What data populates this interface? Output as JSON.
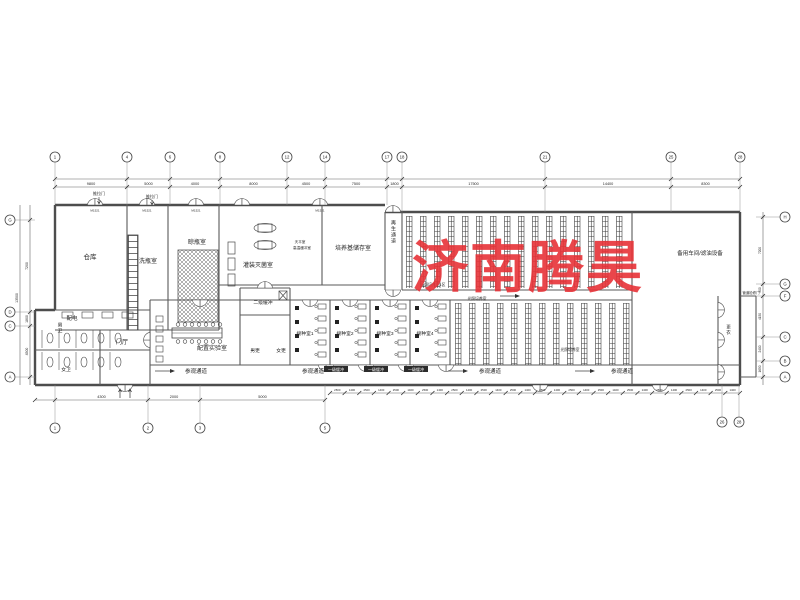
{
  "watermark": {
    "text": "济南腾昊",
    "color": "#e73338"
  },
  "grid": {
    "top": [
      "1",
      "4",
      "6",
      "8",
      "12",
      "14",
      "17",
      "18",
      "21",
      "25",
      "28"
    ],
    "bottom_left": [
      "1",
      "2",
      "3",
      "5"
    ],
    "bottom_right": [
      "26",
      "28"
    ],
    "left": [
      "G",
      "D",
      "C",
      "A"
    ],
    "right": [
      "H",
      "G",
      "F",
      "C",
      "B",
      "A"
    ]
  },
  "dims": {
    "top_row": [
      "9800",
      "5000",
      "4000",
      "8000",
      "4500",
      "7500",
      "1800",
      "17500",
      "14400",
      "8300"
    ],
    "bottom_left_row": [
      "4300",
      "2000",
      "5000"
    ],
    "bottom_ticks": [
      "2500",
      "1400"
    ],
    "left_col": [
      "7200",
      "1800",
      "4500"
    ],
    "left_total": "13500",
    "right_col": [
      "7200",
      "900",
      "4150",
      "2400",
      "1650"
    ]
  },
  "rooms": {
    "warehouse": "仓库",
    "bottle_wash": "洗瓶室",
    "bottle_dry": "晾瓶室",
    "filling": "灌装灭菌室",
    "medium_storage": "培养基储存室",
    "regen_corridor": "再生通道",
    "spare_workshop": "备用车间/滤油设备",
    "power": "配电",
    "toilet_m": "男卫",
    "toilet_f": "女卫",
    "hall": "门厅",
    "prep_lab": "配置实验室",
    "buffer2": "二级缓冲",
    "change_m": "男更",
    "change_f": "女更",
    "inoc1": "接种室1",
    "inoc2": "接种室2",
    "inoc3": "接种室3",
    "inoc4": "接种室4",
    "visitor": "参观通道",
    "light_culture": "光照培养室",
    "light_culture1": "光照培养室1区",
    "change": "更衣"
  },
  "annotations": {
    "sliding_door": "推拉门",
    "balance": "天平室",
    "hot_buffer": "高温缓冲室",
    "pipe_door": "管道检修门",
    "buffer1": "一级缓冲",
    "door_code": "M1521"
  }
}
